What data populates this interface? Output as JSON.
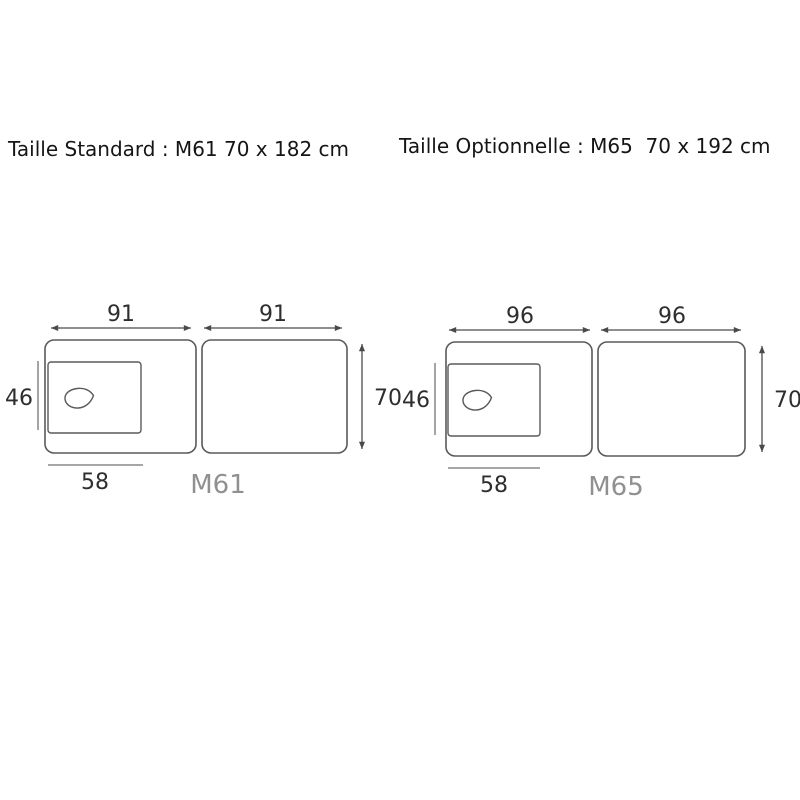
{
  "titles": {
    "standard": "Taille Standard : M61 70 x 182 cm",
    "optionnelle": "Taille Optionnelle : M65  70 x 192 cm"
  },
  "colors": {
    "background": "#ffffff",
    "outline": "#5a5a5a",
    "dimension_line": "#4a4a4a",
    "reference_line": "#9a9a9a",
    "dimension_text": "#2e2e2e",
    "model_text": "#909090",
    "title_text": "#151515"
  },
  "diagrams": [
    {
      "model": "M61",
      "dims": {
        "section1_length": "91",
        "section2_length": "91",
        "headrest_height": "46",
        "table_width": "70",
        "headrest_width": "58"
      }
    },
    {
      "model": "M65",
      "dims": {
        "section1_length": "96",
        "section2_length": "96",
        "headrest_height": "46",
        "table_width": "70",
        "headrest_width": "58"
      }
    }
  ]
}
